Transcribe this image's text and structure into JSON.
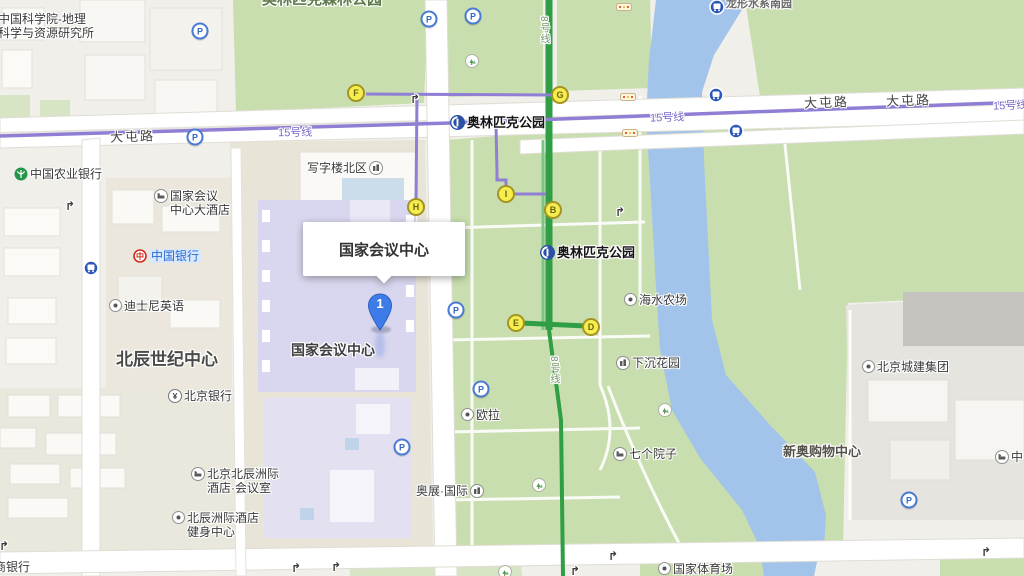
{
  "app": {
    "type": "map-viewer"
  },
  "info_window": {
    "title": "国家会议中心"
  },
  "marker": {
    "label": "1"
  },
  "colors": {
    "land": "#F1EFEA",
    "park": "#C8DEAE",
    "park_light": "#D7E5C5",
    "river": "#A2C3EA",
    "road": "#FFFFFF",
    "road_casing": "#E0DDD5",
    "line15": "#8F7ED4",
    "line8": "#2F9E44",
    "exit_fill": "#F6ED4F",
    "marker_blue": "#3D7BE8",
    "building_lavender": "#D9D7EF"
  },
  "road_labels": [
    {
      "id": "datunlu-west",
      "text": "大屯路",
      "x": 110,
      "y": 126,
      "rot": -2
    },
    {
      "id": "datunlu-east1",
      "text": "大屯路",
      "x": 804,
      "y": 92,
      "rot": -2
    },
    {
      "id": "datunlu-east2",
      "text": "大屯路",
      "x": 886,
      "y": 90,
      "rot": -2
    }
  ],
  "metro_labels": [
    {
      "id": "line15-west",
      "text": "15号线",
      "x": 278,
      "y": 124,
      "rot": -1,
      "cls": "m15"
    },
    {
      "id": "line15-mid",
      "text": "15号线",
      "x": 650,
      "y": 109,
      "rot": -2,
      "cls": "m15"
    },
    {
      "id": "line15-east",
      "text": "15号线",
      "x": 993,
      "y": 97,
      "rot": -2,
      "cls": "m15"
    },
    {
      "id": "line8-north",
      "text": "8号线",
      "x": 536,
      "y": 16,
      "cls": "m8"
    },
    {
      "id": "line8-south",
      "text": "8号线",
      "x": 546,
      "y": 356,
      "cls": "m8"
    }
  ],
  "area_labels": [
    {
      "id": "beichen-century-center",
      "text": "北辰世纪中心",
      "x": 116,
      "y": 345,
      "size": 17,
      "color": "#4a4a4a"
    },
    {
      "id": "cncc-building-label",
      "text": "国家会议中心",
      "x": 291,
      "y": 340,
      "size": 14,
      "color": "#3f3f3f"
    },
    {
      "id": "xinao-shopping-mall",
      "text": "新奥购物中心",
      "x": 783,
      "y": 441,
      "size": 13,
      "color": "#55514b"
    },
    {
      "id": "olympic-forest-park-clipped",
      "text": "奥林匹克森林公园",
      "x": 262,
      "y": -12,
      "size": 15,
      "color": "#5e7a4c"
    },
    {
      "id": "longxing-water-clipped",
      "text": "龙形水系南园",
      "x": 726,
      "y": -5,
      "size": 11,
      "color": "#6b6b6b"
    }
  ],
  "pois": [
    {
      "id": "cas-geography-institute",
      "lines": [
        "中国科学院-地理",
        "科学与资源研究所"
      ],
      "x": -4,
      "y": 12,
      "icon": ""
    },
    {
      "id": "abc-bank",
      "lines": [
        "中国农业银行"
      ],
      "x": 14,
      "y": 167,
      "icon": "bank-abc"
    },
    {
      "id": "cncc-grand-hotel",
      "lines": [
        "国家会议",
        "中心大酒店"
      ],
      "x": 154,
      "y": 189,
      "icon": "hotel"
    },
    {
      "id": "bank-of-china",
      "lines": [
        "中国银行"
      ],
      "x": 133,
      "y": 249,
      "icon": "boc",
      "pill": true
    },
    {
      "id": "disney-english",
      "lines": [
        "迪士尼英语"
      ],
      "x": 109,
      "y": 299,
      "icon": "dot"
    },
    {
      "id": "bank-of-beijing",
      "lines": [
        "北京银行"
      ],
      "x": 168,
      "y": 389,
      "icon": "yen"
    },
    {
      "id": "intercontinental-hotel-meeting",
      "lines": [
        "北京北辰洲际",
        "酒店·会议室"
      ],
      "x": 191,
      "y": 467,
      "icon": "hotel"
    },
    {
      "id": "intercontinental-gym",
      "lines": [
        "北辰洲际酒店",
        "健身中心"
      ],
      "x": 172,
      "y": 511,
      "icon": "dot"
    },
    {
      "id": "office-building-north",
      "lines": [
        "写字楼北区"
      ],
      "x": 305,
      "y": 161,
      "icon": "bld",
      "iconSide": "right"
    },
    {
      "id": "subway-olympic-park-north",
      "lines": [
        "奥林匹克公园"
      ],
      "x": 450,
      "y": 115,
      "icon": "metro",
      "station": true
    },
    {
      "id": "subway-olympic-park-south",
      "lines": [
        "奥林匹克公园"
      ],
      "x": 540,
      "y": 245,
      "icon": "metro",
      "station": true
    },
    {
      "id": "haishui-farm",
      "lines": [
        "海水农场"
      ],
      "x": 624,
      "y": 293,
      "icon": "dot"
    },
    {
      "id": "sunken-garden",
      "lines": [
        "下沉花园"
      ],
      "x": 616,
      "y": 356,
      "icon": "bld"
    },
    {
      "id": "oula",
      "lines": [
        "欧拉"
      ],
      "x": 461,
      "y": 408,
      "icon": "dot"
    },
    {
      "id": "aozhan-international",
      "lines": [
        "奥展·国际"
      ],
      "x": 414,
      "y": 484,
      "icon": "bld",
      "iconSide": "right"
    },
    {
      "id": "seven-courtyards",
      "lines": [
        "七个院子"
      ],
      "x": 613,
      "y": 447,
      "icon": "hotel"
    },
    {
      "id": "beijing-chengjian-group",
      "lines": [
        "北京城建集团"
      ],
      "x": 862,
      "y": 360,
      "icon": "dot"
    },
    {
      "id": "icbc-clipped",
      "lines": [
        "商银行"
      ],
      "x": -8,
      "y": 560,
      "icon": ""
    },
    {
      "id": "national-stadium",
      "lines": [
        "国家体育场"
      ],
      "x": 658,
      "y": 562,
      "icon": "dot"
    },
    {
      "id": "clipped-right-hotel",
      "lines": [
        "中"
      ],
      "x": 995,
      "y": 450,
      "icon": "hotel"
    }
  ],
  "exits": [
    {
      "letter": "B",
      "x": 553,
      "y": 210
    },
    {
      "letter": "D",
      "x": 591,
      "y": 327
    },
    {
      "letter": "E",
      "x": 516,
      "y": 323
    },
    {
      "letter": "F",
      "x": 356,
      "y": 93
    },
    {
      "letter": "G",
      "x": 560,
      "y": 95
    },
    {
      "letter": "H",
      "x": 416,
      "y": 207
    },
    {
      "letter": "I",
      "x": 506,
      "y": 194
    }
  ],
  "icons": [
    {
      "t": "p",
      "x": 200,
      "y": 31
    },
    {
      "t": "p",
      "x": 195,
      "y": 137
    },
    {
      "t": "p",
      "x": 429,
      "y": 19
    },
    {
      "t": "p",
      "x": 473,
      "y": 16
    },
    {
      "t": "p",
      "x": 456,
      "y": 310
    },
    {
      "t": "p",
      "x": 481,
      "y": 389
    },
    {
      "t": "p",
      "x": 402,
      "y": 447
    },
    {
      "t": "p",
      "x": 909,
      "y": 500
    },
    {
      "t": "bus",
      "x": 717,
      "y": 7
    },
    {
      "t": "bus",
      "x": 716,
      "y": 95
    },
    {
      "t": "bus",
      "x": 736,
      "y": 131
    },
    {
      "t": "bus",
      "x": 91,
      "y": 268
    },
    {
      "t": "tree",
      "x": 472,
      "y": 61
    },
    {
      "t": "tree",
      "x": 539,
      "y": 485
    },
    {
      "t": "tree",
      "x": 665,
      "y": 410
    },
    {
      "t": "tree",
      "x": 505,
      "y": 572
    },
    {
      "t": "arrow",
      "x": 70,
      "y": 206
    },
    {
      "t": "arrow",
      "x": 415,
      "y": 99
    },
    {
      "t": "arrow",
      "x": 620,
      "y": 212
    },
    {
      "t": "arrow",
      "x": 613,
      "y": 556
    },
    {
      "t": "arrow",
      "x": 575,
      "y": 571
    },
    {
      "t": "arrow",
      "x": 296,
      "y": 568
    },
    {
      "t": "arrow",
      "x": 336,
      "y": 567
    },
    {
      "t": "arrow",
      "x": 986,
      "y": 552
    },
    {
      "t": "arrow",
      "x": 4,
      "y": 546
    },
    {
      "t": "stop",
      "x": 628,
      "y": 97
    },
    {
      "t": "stop",
      "x": 630,
      "y": 133
    },
    {
      "t": "stop",
      "x": 624,
      "y": 7
    }
  ]
}
